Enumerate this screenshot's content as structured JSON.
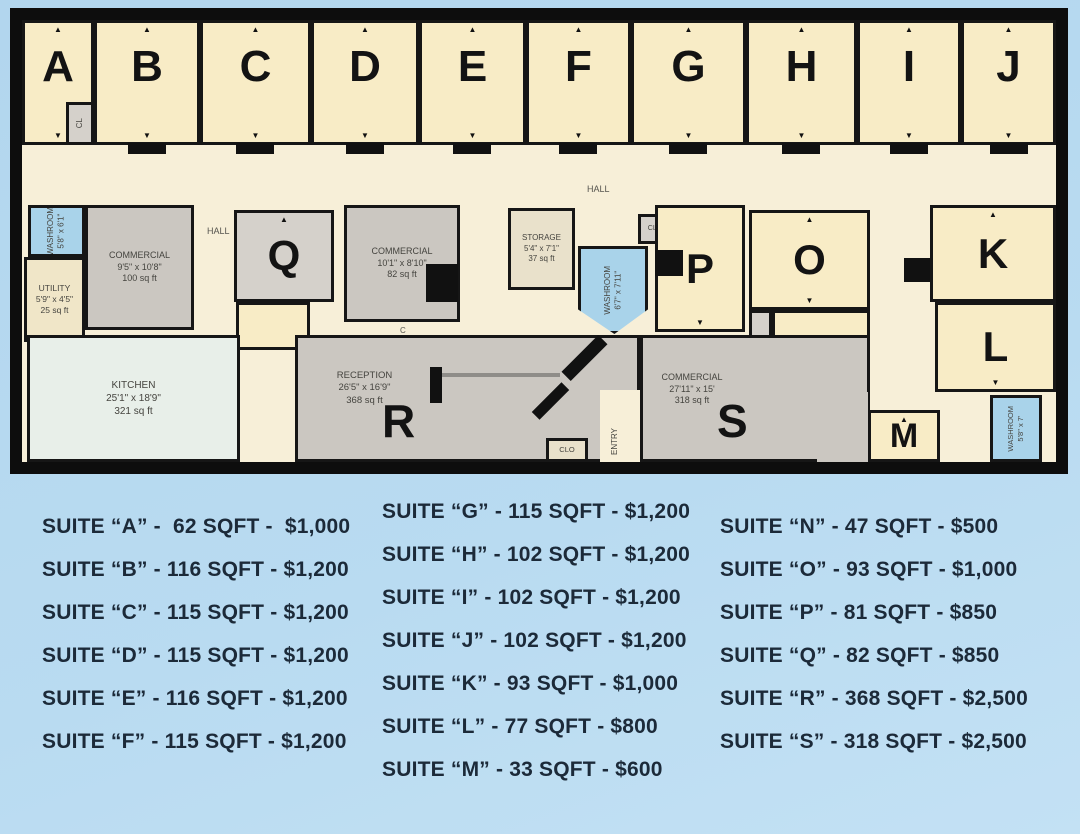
{
  "plan": {
    "rooms": {
      "a": "A",
      "b": "B",
      "c": "C",
      "d": "D",
      "e": "E",
      "f": "F",
      "g": "G",
      "h": "H",
      "i": "I",
      "j": "J",
      "k": "K",
      "l": "L",
      "m": "M",
      "n": "N",
      "o": "O",
      "p": "P",
      "q": "Q",
      "r": "R",
      "s": "S"
    },
    "labels": {
      "hall_upper": "HALL",
      "hall_left": "HALL",
      "cl": "CL",
      "washroom_left": "WASHROOM\n5'8\" x 6'1\"",
      "utility": "UTILITY\n5'9\" x 4'5\"\n25 sq ft",
      "commercial_100": "COMMERCIAL\n9'5\" x 10'8\"\n100 sq ft",
      "commercial_82": "COMMERCIAL\n10'1\" x 8'10\"\n82 sq ft",
      "door_c": "C",
      "storage": "STORAGE\n5'4\" x 7'1\"\n37 sq ft",
      "washroom_mid": "WASHROOM\n6'7\" x 7'11\"",
      "clo_upper": "CLO",
      "closet": "CLOSET",
      "kitchen": "KITCHEN\n25'1\" x 18'9\"\n321 sq ft",
      "reception": "RECEPTION\n26'5\" x 16'9\"\n368 sq ft",
      "commercial_318": "COMMERCIAL\n27'11\" x 15'\n318 sq ft",
      "clo_lower": "CLO",
      "entry": "ENTRY",
      "washroom_br": "WASHROOM\n5'8\" x 7'"
    }
  },
  "listings": {
    "col1": [
      "SUITE “A” -  62 SQFT -  $1,000",
      "SUITE “B” - 116 SQFT - $1,200",
      "SUITE “C” - 115 SQFT - $1,200",
      "SUITE “D” - 115 SQFT - $1,200",
      "SUITE “E” - 116 SQFT - $1,200",
      "SUITE “F” - 115 SQFT - $1,200"
    ],
    "col2": [
      "SUITE “G” - 115 SQFT - $1,200",
      "SUITE “H” - 102 SQFT - $1,200",
      "SUITE “I” - 102 SQFT - $1,200",
      "SUITE “J” - 102 SQFT - $1,200",
      "SUITE “K” - 93 SQFT - $1,000",
      "SUITE “L” - 77 SQFT - $800",
      "SUITE “M” - 33 SQFT - $600"
    ],
    "col3": [
      "SUITE “N” - 47 SQFT - $500",
      "SUITE “O” - 93 SQFT - $1,000",
      "SUITE “P” - 81 SQFT - $850",
      "SUITE “Q” - 82 SQFT - $850",
      "SUITE “R” - 368 SQFT - $2,500",
      "SUITE “S” - 318 SQFT - $2,500"
    ]
  },
  "palette": {
    "page_bg": "#b5d8ef",
    "plan_floor": "#f7efd8",
    "room_cream": "#f8ecc6",
    "room_gray": "#cbc7c1",
    "washroom_blue": "#a9d3ea",
    "kitchen_mint": "#e8efe9",
    "storage_tan": "#e9e1cb",
    "wall_black": "#141414",
    "listing_text": "#1c2a39"
  }
}
